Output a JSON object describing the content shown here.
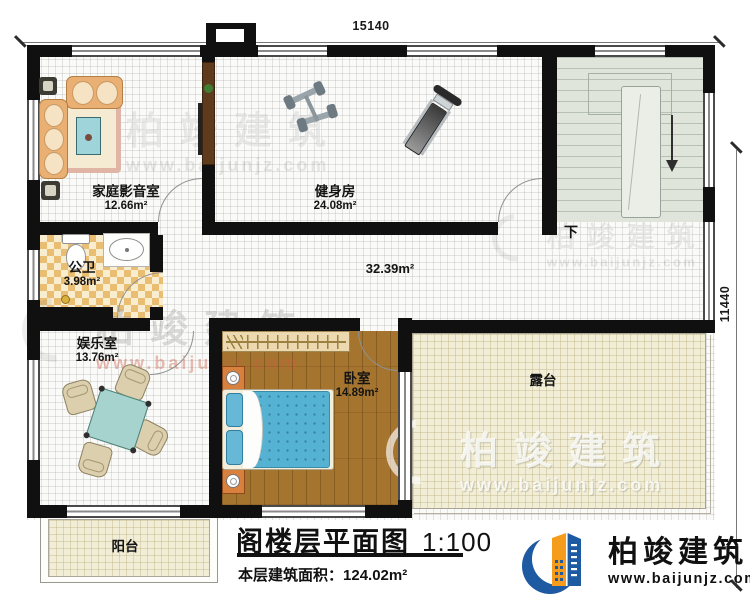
{
  "dimensions": {
    "top": "15140",
    "right": "11440"
  },
  "rooms": {
    "home_theater": {
      "name": "家庭影音室",
      "area": "12.66m²"
    },
    "gym": {
      "name": "健身房",
      "area": "24.08m²"
    },
    "bathroom": {
      "name": "公卫",
      "area": "3.98m²"
    },
    "entertainment": {
      "name": "娱乐室",
      "area": "13.76m²"
    },
    "bedroom": {
      "name": "卧室",
      "area": "14.89m²"
    },
    "hallway": {
      "area": "32.39m²"
    },
    "terrace": {
      "name": "露台"
    },
    "balcony": {
      "name": "阳台"
    }
  },
  "stairs": {
    "direction_label": "下"
  },
  "title": {
    "main": "阁楼层平面图",
    "scale": "1:100",
    "area_prefix": "本层建筑面积：",
    "area_value": "124.02m²"
  },
  "brand": {
    "name": "柏竣建筑",
    "url": "www.baijunjz.com"
  },
  "colors": {
    "wall": "#101010",
    "stair_floor": "#dfe5db",
    "wood_floor": "#a5752f",
    "terrace_floor": "#f1edd6",
    "bathroom_tile": "#e9bd72",
    "logo_blue": "#1e5aa2",
    "logo_orange": "#f59c1c"
  }
}
